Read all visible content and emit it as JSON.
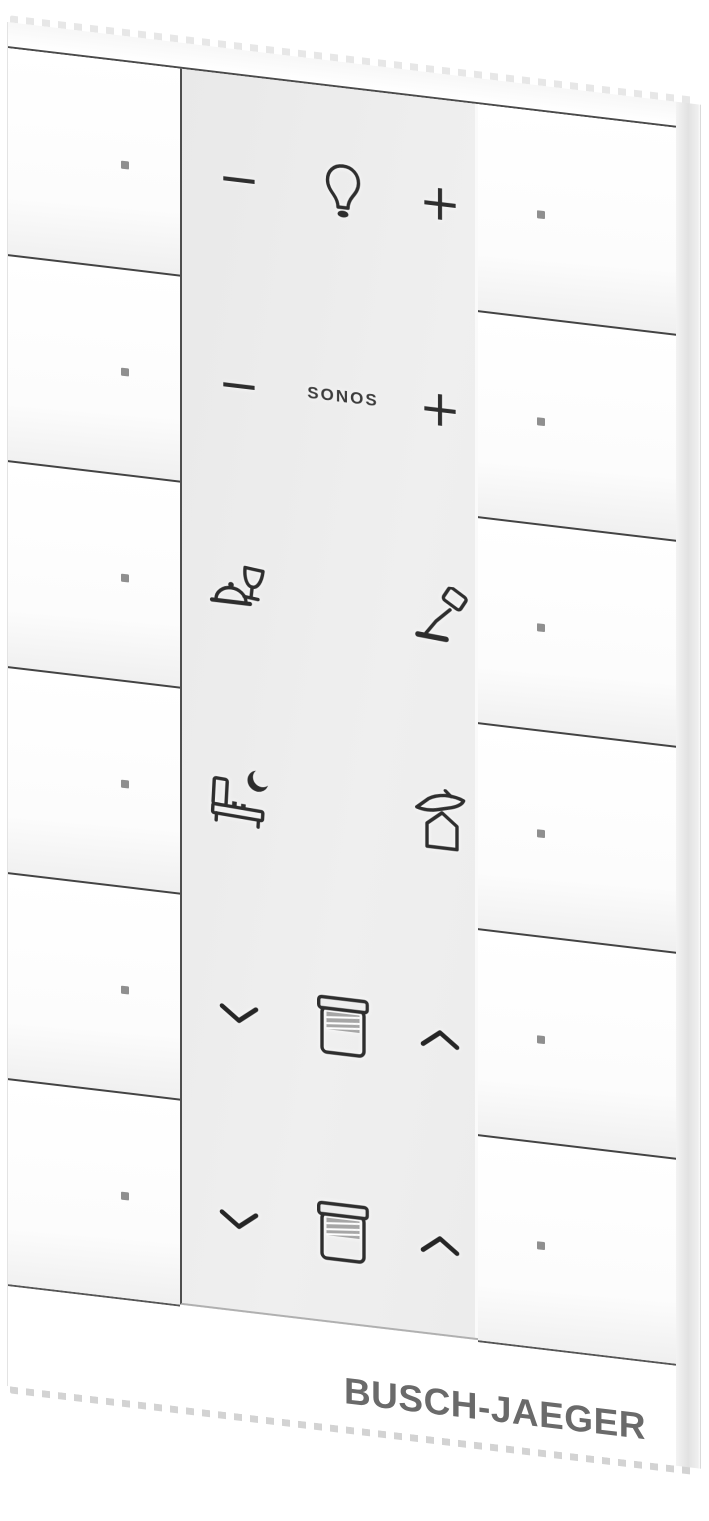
{
  "branding": {
    "label": "BUSCH-JAEGER",
    "color": "#6a6a6a"
  },
  "panel": {
    "background": "#ededed",
    "rows": [
      {
        "name": "light-dimmer",
        "minus": "−",
        "plus": "+",
        "center_icon": "light-bulb-icon"
      },
      {
        "name": "sonos-volume",
        "minus": "−",
        "plus": "+",
        "label": "SONOS"
      },
      {
        "name": "scenes-upper",
        "left_icon": "dinner-scene-icon",
        "right_icon": "reading-lamp-icon"
      },
      {
        "name": "scenes-lower",
        "left_icon": "sleep-scene-icon",
        "right_icon": "away-scene-icon"
      },
      {
        "name": "blind-upper",
        "left_icon": "chevron-down-icon",
        "center_icon": "roller-blind-icon",
        "right_icon": "chevron-up-icon"
      },
      {
        "name": "blind-lower",
        "left_icon": "chevron-down-icon",
        "center_icon": "roller-blind-icon",
        "right_icon": "chevron-up-icon"
      }
    ]
  },
  "rockers": {
    "left": {
      "count": 6,
      "marker": "square-dot"
    },
    "right": {
      "count": 6,
      "marker": "square-dot"
    }
  },
  "colors": {
    "background": "#ffffff",
    "face": "#ffffff",
    "panel_gray": "#ededed",
    "separator": "#434343",
    "icon_ink": "#2e2e2e",
    "status_dot": "#8f8f8f",
    "brand_text": "#6a6a6a",
    "side_shade": "#e2e2e2"
  }
}
